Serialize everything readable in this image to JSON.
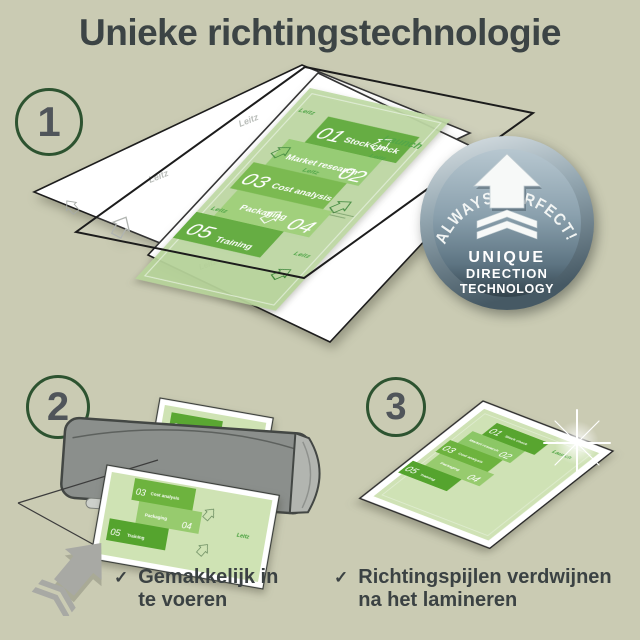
{
  "title": "Unieke richtingstechnologie",
  "steps": [
    {
      "number": "1"
    },
    {
      "number": "2"
    },
    {
      "number": "3"
    }
  ],
  "badge": {
    "arc_text": "ALWAYS PERFECT!",
    "line1": "UNIQUE",
    "line2": "DIRECTION",
    "line3": "TECHNOLOGY"
  },
  "document": {
    "launch_label": "Launch",
    "brand_watermark": "Leitz",
    "bands": [
      {
        "num": "01",
        "label": "Stock check"
      },
      {
        "num": "02",
        "label": "Market research"
      },
      {
        "num": "03",
        "label": "Cost analysis"
      },
      {
        "num": "04",
        "label": "Packaging"
      },
      {
        "num": "05",
        "label": "Training"
      }
    ]
  },
  "checklist": [
    {
      "check": "✓",
      "line1": "Gemakkelijk in",
      "line2": "te voeren"
    },
    {
      "check": "✓",
      "line1": "Richtingspijlen verdwijnen",
      "line2": "na het lamineren"
    }
  ],
  "colors": {
    "background": "#cacbb3",
    "title_text": "#3c4445",
    "circle_ring_green": "#2d5330",
    "band_dark_green": "#55a42e",
    "band_mid_green": "#6db33e",
    "band_light_green": "#8cc766",
    "band_pale_green": "#97cb6e",
    "doc_background_green": "#cfe3b4",
    "launch_green": "#3f9c35",
    "badge_blue_gray": "#8ba0ac",
    "machine_gray": "#8b8f8c"
  }
}
